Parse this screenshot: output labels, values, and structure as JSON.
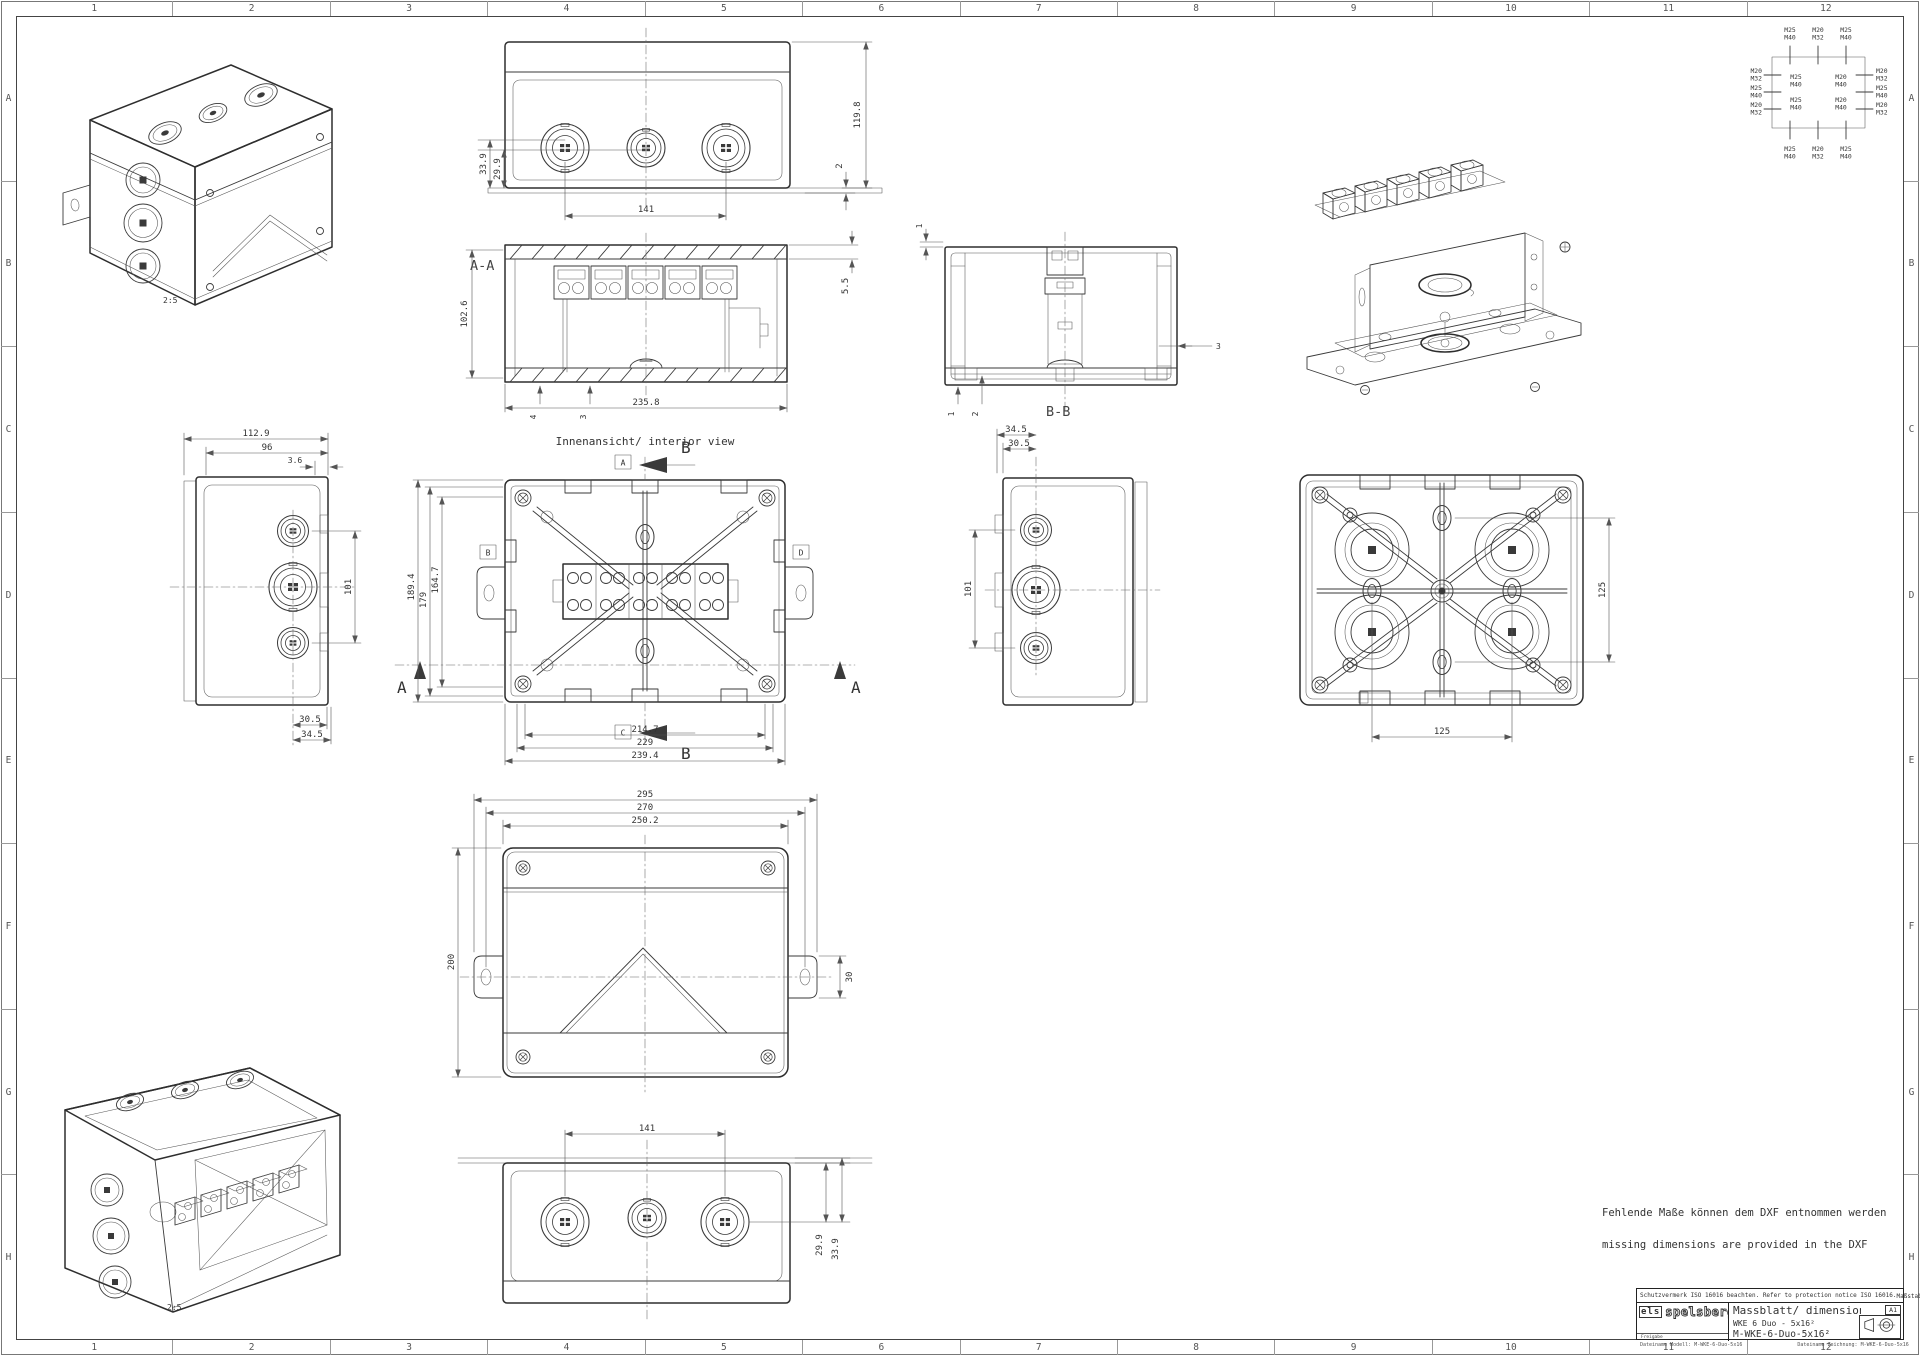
{
  "colors": {
    "line": "#3a3a3a",
    "dim_line": "#555555",
    "text": "#333333",
    "background": "#ffffff"
  },
  "sheet": {
    "frame": {
      "cols": [
        "1",
        "2",
        "3",
        "4",
        "5",
        "6",
        "7",
        "8",
        "9",
        "10",
        "11",
        "12"
      ],
      "rows": [
        "A",
        "B",
        "C",
        "D",
        "E",
        "F",
        "G",
        "H"
      ]
    },
    "notes": {
      "de": "Fehlende Maße können dem DXF entnommen werden",
      "en": "missing dimensions are provided in the DXF"
    }
  },
  "title_block": {
    "protection_notice": "Schutzvermerk ISO 16016 beachten. Refer to protection notice ISO 16016.",
    "scale_label": "Maßstab:",
    "scale_value": "1:2",
    "logo_prefix": "els",
    "logo_name": "spelsberg",
    "approval_label": "Freigabe",
    "doc_title": "Massblatt/ dimension sheet",
    "product_name": "WKE 6 Duo - 5x16²",
    "drawing_number": "M-WKE-6-Duo-5x16²",
    "format": "A1",
    "file_model": "Dateiname Modell: M-WKE-6-Duo-5x16",
    "file_drawing": "Dateiname Zeichnung: M-WKE-6-Duo-5x16"
  },
  "knockout_chart": {
    "top": [
      [
        "M25",
        "M40"
      ],
      [
        "M20",
        "M32"
      ],
      [
        "M25",
        "M40"
      ]
    ],
    "bottom": [
      [
        "M25",
        "M40"
      ],
      [
        "M20",
        "M32"
      ],
      [
        "M25",
        "M40"
      ]
    ],
    "left": [
      [
        "M20",
        "M32"
      ],
      [
        "M25",
        "M40"
      ],
      [
        "M20",
        "M32"
      ]
    ],
    "right": [
      [
        "M20",
        "M32"
      ],
      [
        "M25",
        "M40"
      ],
      [
        "M20",
        "M32"
      ]
    ],
    "inner_left": [
      [
        "M25",
        "M40"
      ],
      [
        "M25",
        "M40"
      ]
    ],
    "inner_right": [
      [
        "M20",
        "M40"
      ],
      [
        "M20",
        "M40"
      ]
    ]
  },
  "views": {
    "iso_closed": {
      "scale": "2:5"
    },
    "iso_open": {
      "scale": "2:5"
    },
    "top_view": {
      "dim_spacing": "141",
      "dim_height": "119.8",
      "dim_foot": "2",
      "dim_center_a": "33.9",
      "dim_center_b": "29.9"
    },
    "section_aa": {
      "label": "A-A",
      "dim_height": "102.6",
      "dim_width": "235.8",
      "dim_lid": "5.5",
      "dim_rib": "4",
      "dim_wall": "3"
    },
    "section_bb": {
      "label": "B-B",
      "dim_gap": "1",
      "dim_foot_a": "1",
      "dim_foot_b": "2",
      "dim_wall": "3"
    },
    "side_left": {
      "dim_depth": "112.9",
      "dim_body": "96",
      "dim_lip": "3.6",
      "dim_pitch": "101",
      "dim_off_a": "30.5",
      "dim_off_b": "34.5"
    },
    "interior": {
      "title": "Innenansicht/ interior view",
      "cut_a": "A",
      "cut_b": "B",
      "cut_c": "C",
      "cut_d": "D",
      "sec_b": "B",
      "sec_a": "A",
      "dim_h_outer": "189.4",
      "dim_h_mid": "179",
      "dim_h_inner": "164.7",
      "dim_w_inner": "214.7",
      "dim_w_mid": "229",
      "dim_w_outer": "239.4"
    },
    "side_right": {
      "dim_off_a": "34.5",
      "dim_off_b": "30.5",
      "dim_pitch": "101"
    },
    "lid_interior": {
      "dim_v": "125",
      "dim_h": "125"
    },
    "lid_front": {
      "dim_w_outer": "295",
      "dim_w_mid": "270",
      "dim_w_inner": "250.2",
      "dim_height": "200",
      "dim_ear": "30"
    },
    "bottom_view": {
      "dim_spacing": "141",
      "dim_center_a": "29.9",
      "dim_center_b": "33.9"
    }
  }
}
